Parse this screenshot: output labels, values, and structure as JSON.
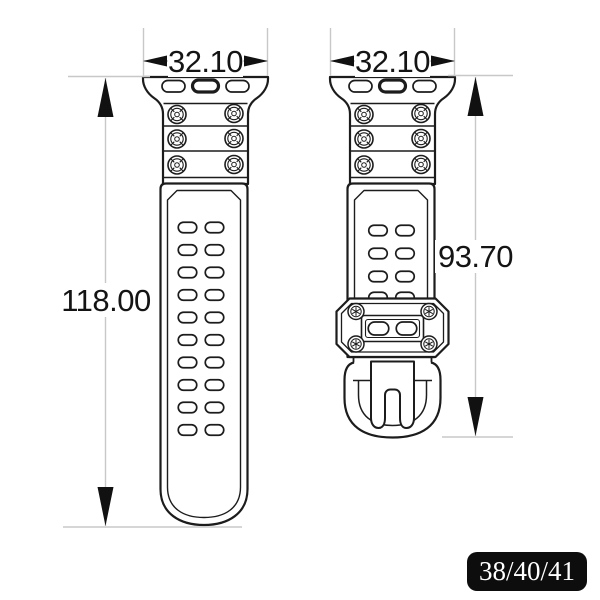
{
  "diagram": {
    "left_strap": {
      "width_label": "32.10",
      "length_label": "118.00"
    },
    "right_strap": {
      "width_label": "32.10",
      "length_label": "93.70"
    }
  },
  "badge": {
    "label": "38/40/41"
  },
  "colors": {
    "outline": "#1c1c1c",
    "dimension_line": "#c8c8c8",
    "dimension_text": "#141414",
    "badge_background": "#0d0d0d",
    "badge_text": "#ffffff",
    "background": "#ffffff"
  }
}
